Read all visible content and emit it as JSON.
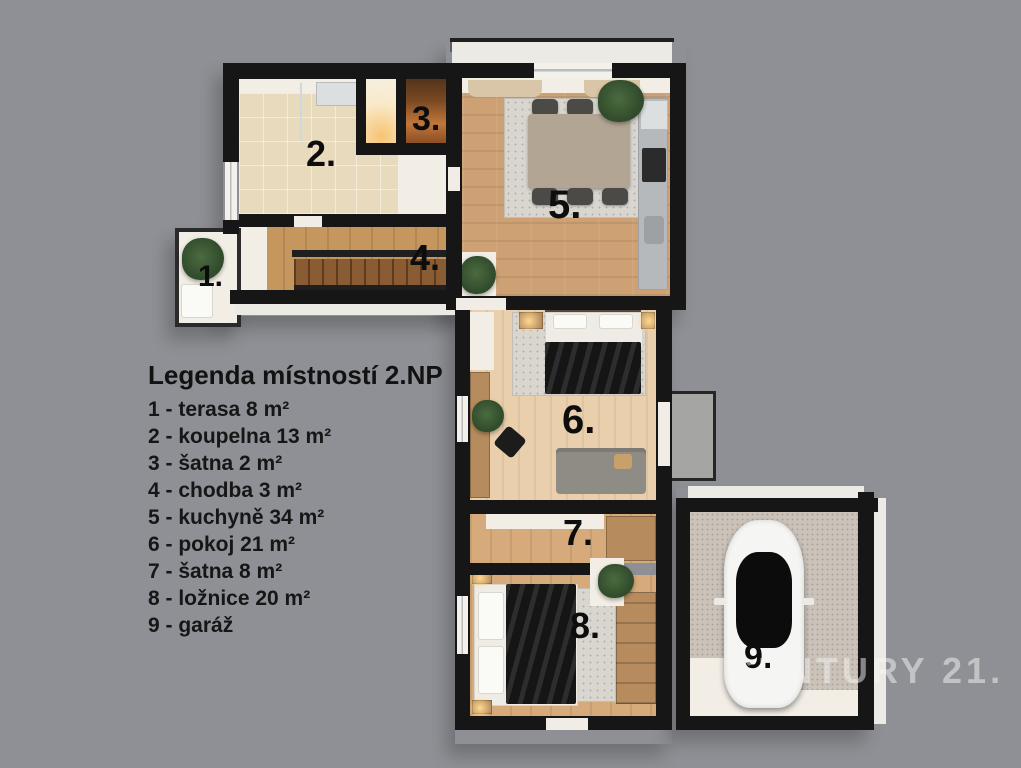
{
  "canvas": {
    "background_color": "#8e9095"
  },
  "legend": {
    "title": "Legenda místností 2.NP",
    "items": [
      "1 - terasa 8 m²",
      "2 - koupelna 13 m²",
      "3 - šatna 2 m²",
      "4 - chodba 3 m²",
      "5 - kuchyně 34 m²",
      "6 - pokoj 21 m²",
      "7 - šatna 8 m²",
      "8 - ložnice 20 m²",
      "9 - garáž"
    ]
  },
  "rooms": [
    {
      "number": "1.",
      "name": "terasa",
      "area": "8 m²"
    },
    {
      "number": "2.",
      "name": "koupelna",
      "area": "13 m²"
    },
    {
      "number": "3.",
      "name": "šatna",
      "area": "2 m²"
    },
    {
      "number": "4.",
      "name": "chodba",
      "area": "3 m²"
    },
    {
      "number": "5.",
      "name": "kuchyně",
      "area": "34 m²"
    },
    {
      "number": "6.",
      "name": "pokoj",
      "area": "21 m²"
    },
    {
      "number": "7.",
      "name": "šatna",
      "area": "8 m²"
    },
    {
      "number": "8.",
      "name": "ložnice",
      "area": "20 m²"
    },
    {
      "number": "9.",
      "name": "garáž",
      "area": ""
    }
  ],
  "watermark": "CENTURY 21.",
  "colors": {
    "background": "#8e9095",
    "wall": "#161616",
    "wood_floor": "#cda173",
    "pale_wood_floor": "#e9cfac",
    "tile_floor": "#e7dabd",
    "concrete_floor": "#cbc3ba",
    "legend_text": "#161616",
    "watermark_text": "#f6f6f6"
  }
}
